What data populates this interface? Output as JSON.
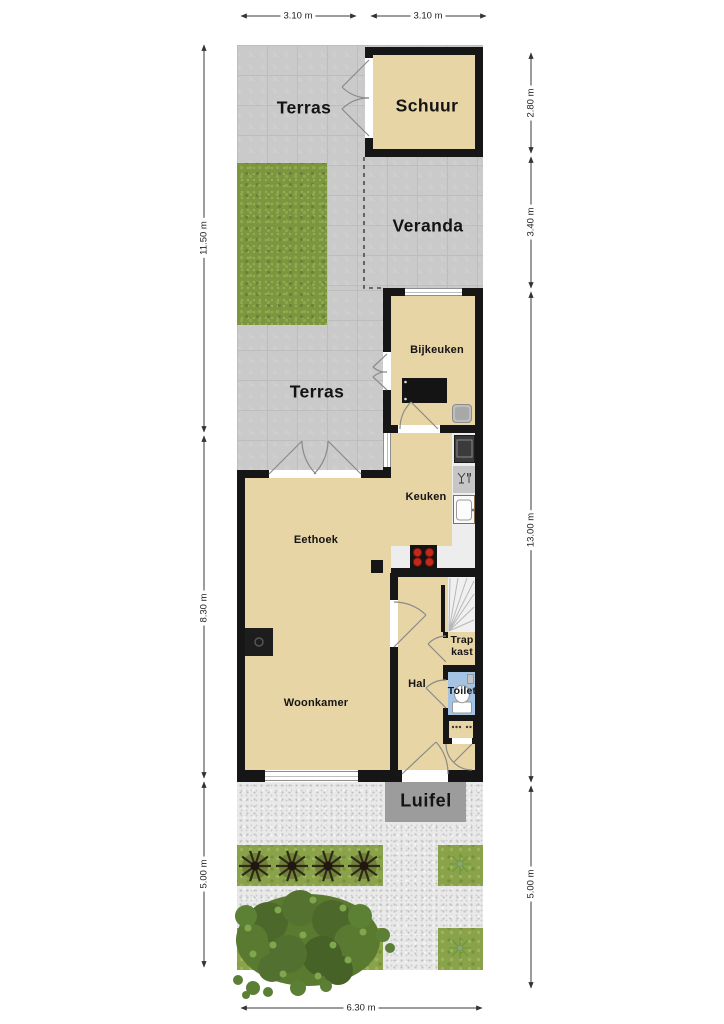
{
  "areas": {
    "terras_top": {
      "label": "Terras"
    },
    "schuur": {
      "label": "Schuur"
    },
    "veranda": {
      "label": "Veranda"
    },
    "terras_mid": {
      "label": "Terras"
    },
    "luifel": {
      "label": "Luifel"
    }
  },
  "rooms": {
    "bijkeuken": {
      "label": "Bijkeuken"
    },
    "keuken": {
      "label": "Keuken"
    },
    "eethoek": {
      "label": "Eethoek"
    },
    "woonkamer": {
      "label": "Woonkamer"
    },
    "hal": {
      "label": "Hal"
    },
    "trapkast": {
      "label": "Trap kast"
    },
    "toilet": {
      "label": "Toilet"
    }
  },
  "dimensions": {
    "top_left": "3.10 m",
    "top_right": "3.10 m",
    "left_garden_top": "11.50 m",
    "left_house": "8.30 m",
    "left_garden_bottom": "5.00 m",
    "right_schuur": "2.80 m",
    "right_veranda": "3.40 m",
    "right_house": "13.00 m",
    "right_garden": "5.00 m",
    "bottom": "6.30 m"
  },
  "icons": {
    "stairs": "stairs-icon",
    "toilet": "toilet-icon",
    "washing_machine": "washing-machine-icon",
    "utility_sink": "utility-sink-icon",
    "oven": "oven-icon",
    "dishwasher": "dishwasher-icon",
    "kitchen_sink": "kitchen-sink-icon",
    "cooktop": "cooktop-icon",
    "fireplace": "fireplace-icon",
    "meter_cupboard": "meter-cupboard-icon",
    "tree": "tree-icon",
    "shrub": "shrub-icon",
    "plant": "plant-icon"
  },
  "colors": {
    "floor": "#e7d5a5",
    "wall": "#161616",
    "paving": "#cacaca",
    "gravel": "#e9e9e9",
    "grass": "#7c963f",
    "toilet_floor": "#a5c3e3",
    "canopy": "#9c9c9c",
    "burner": "#c3271d"
  }
}
